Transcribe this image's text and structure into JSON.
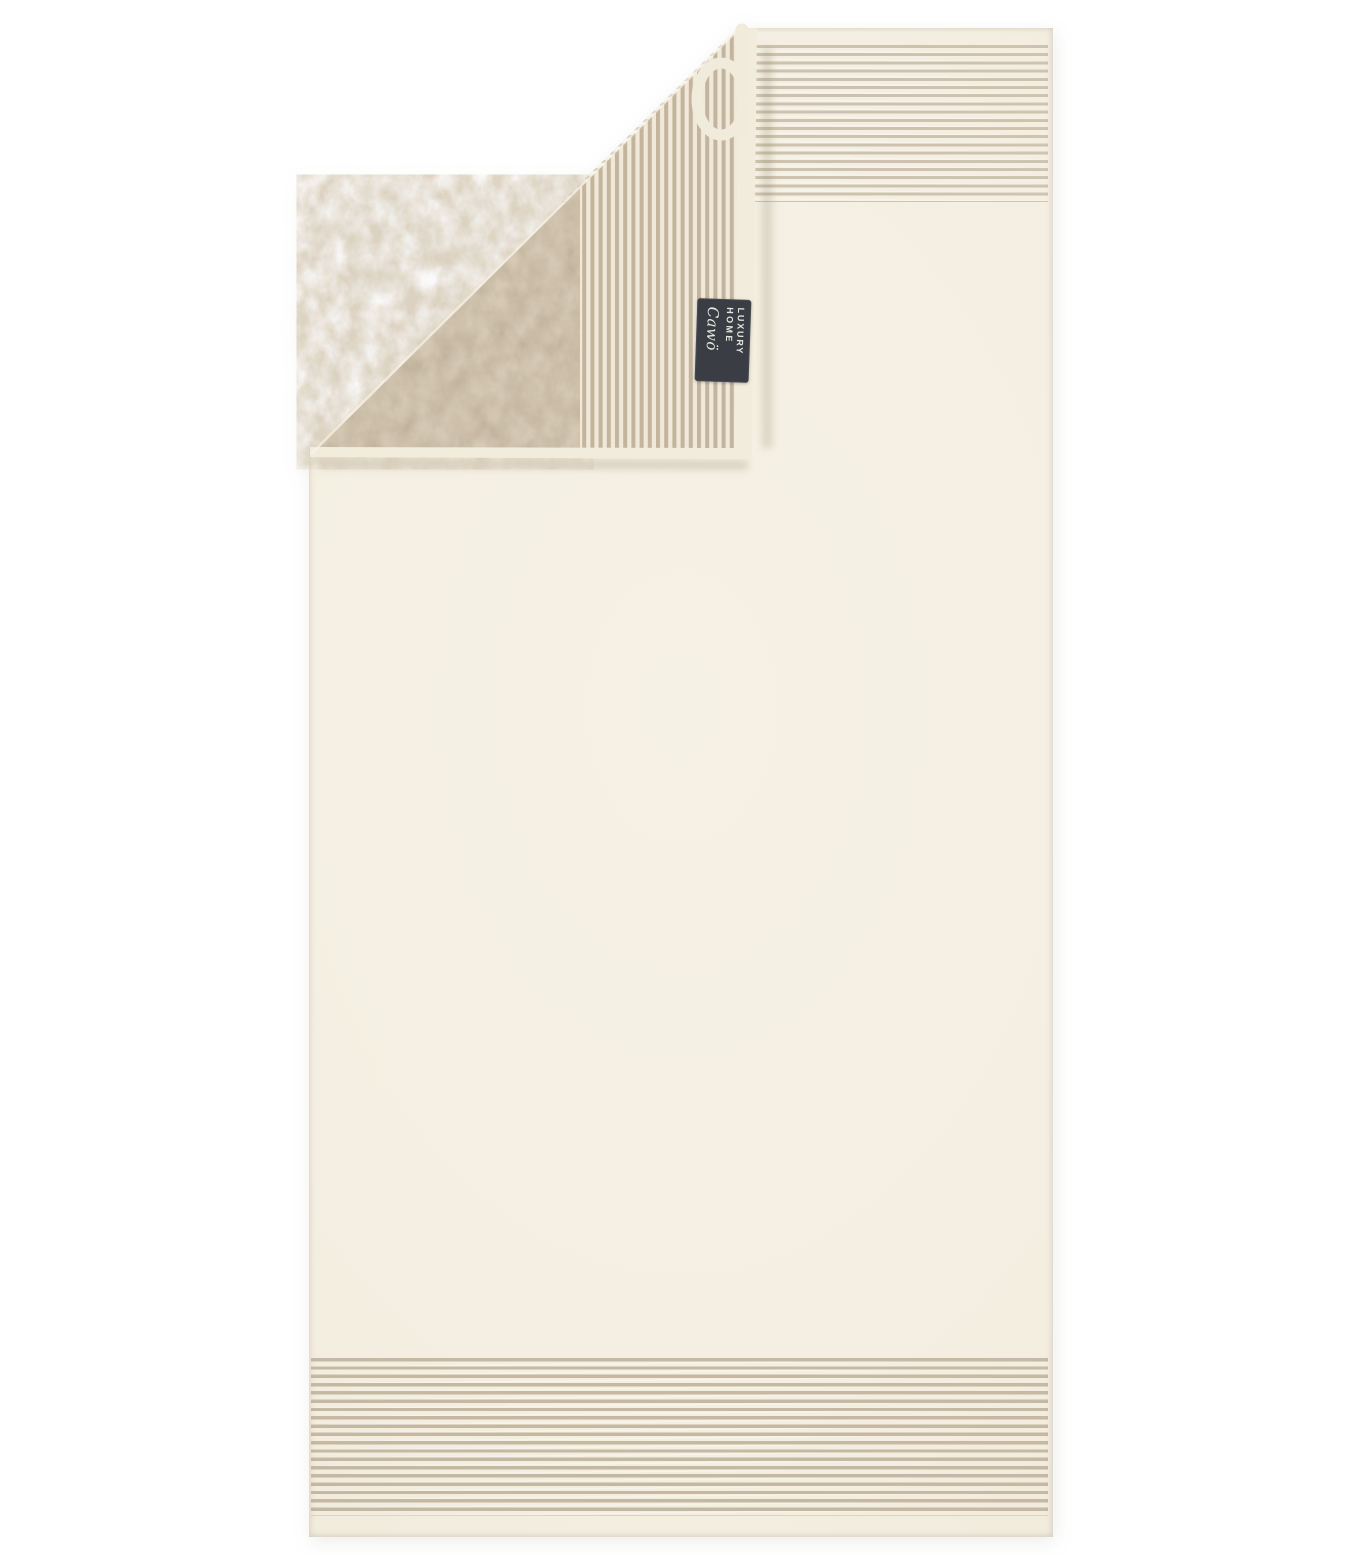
{
  "scene": {
    "description": "Product photo of a cream terry towel with thin beige striped borders at top and bottom; the top-left corner is folded over showing the solid beige reverse side with a vertical ribbed stripe border, a cream hanging loop and a dark woven brand label",
    "background_color": "#ffffff"
  },
  "colors": {
    "page_bg": "#ffffff",
    "front": "#f4efe2",
    "front_light": "#f6f1e5",
    "front_dark": "#efe8d8",
    "hem": "#f2ecdc",
    "back_beige": "#c1b29b",
    "back_mottle": "#d8ccb8",
    "stripe_top": "rgba(167,150,124,0.50)",
    "stripe_bottom": "rgba(159,140,112,0.55)",
    "fold_base": "#f0e9da",
    "fold_bar": "#c3b49d",
    "loop": "#f1ebdc",
    "tag_bg": "#3a3e44",
    "tag_text": "#e8e7e3"
  },
  "label_tag": {
    "lines": [
      "LUXURY",
      "HOME",
      "Cawö"
    ]
  }
}
